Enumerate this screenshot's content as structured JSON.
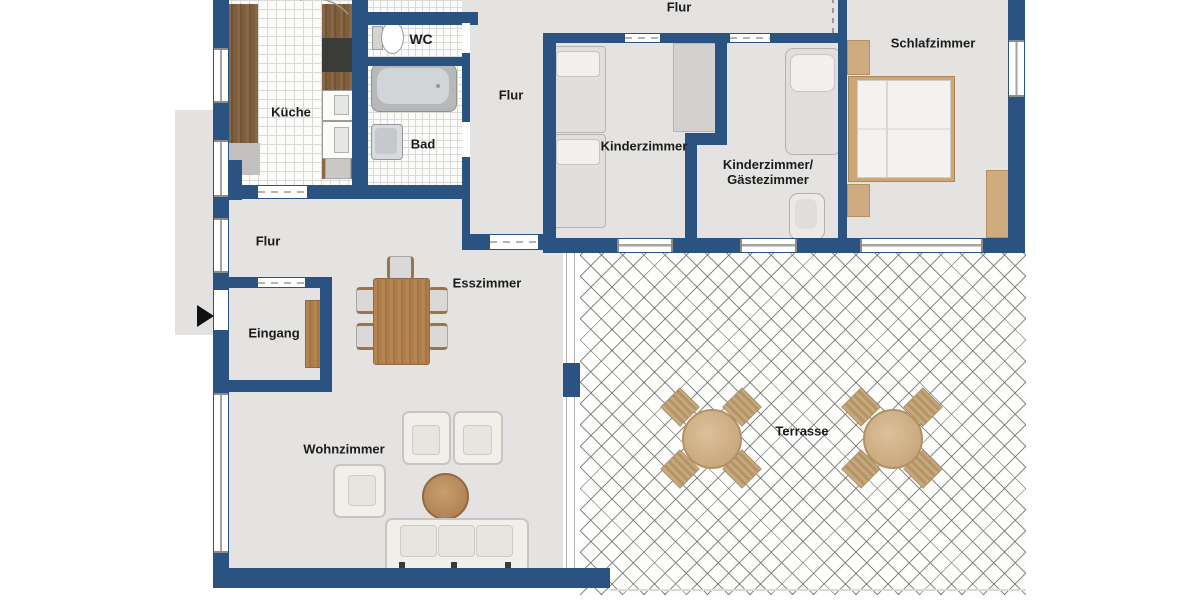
{
  "labels": {
    "kueche": "Küche",
    "wc": "WC",
    "bad": "Bad",
    "flur_top": "Flur",
    "flur_mid": "Flur",
    "flur_lower": "Flur",
    "kinderzimmer": "Kinderzimmer",
    "gaestezimmer_line1": "Kinderzimmer/",
    "gaestezimmer_line2": "Gästezimmer",
    "schlafzimmer": "Schlafzimmer",
    "esszimmer": "Esszimmer",
    "eingang": "Eingang",
    "wohnzimmer": "Wohnzimmer",
    "terrasse": "Terrasse"
  },
  "colors": {
    "wall": "#2b5381",
    "floor": "#e4e3e1",
    "tile_line": "#d9d9d7",
    "wood_dark": "#7f5e3d",
    "wood_mid": "#ad7d4c",
    "furniture_tan": "#cfac7f",
    "upholstery_cream": "#f1efe9",
    "appliance_dark": "#3b3b39",
    "label_text": "#1b1b1b"
  }
}
